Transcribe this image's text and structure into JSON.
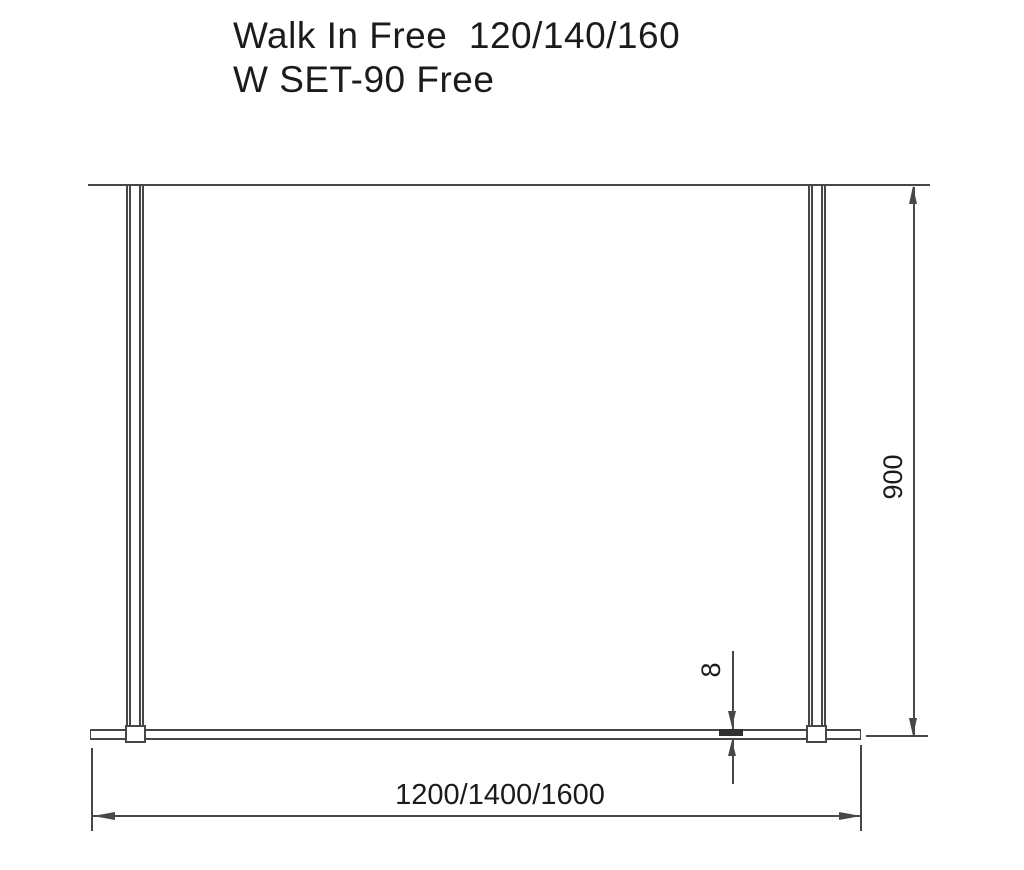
{
  "title": {
    "line1": "Walk In Free  120/140/160",
    "line2": "W SET-90 Free"
  },
  "dimensions": {
    "height": "900",
    "glass_thickness": "8",
    "width": "1200/1400/1600"
  },
  "colors": {
    "line": "#474747",
    "text": "#1b1b1b",
    "background": "#ffffff"
  }
}
